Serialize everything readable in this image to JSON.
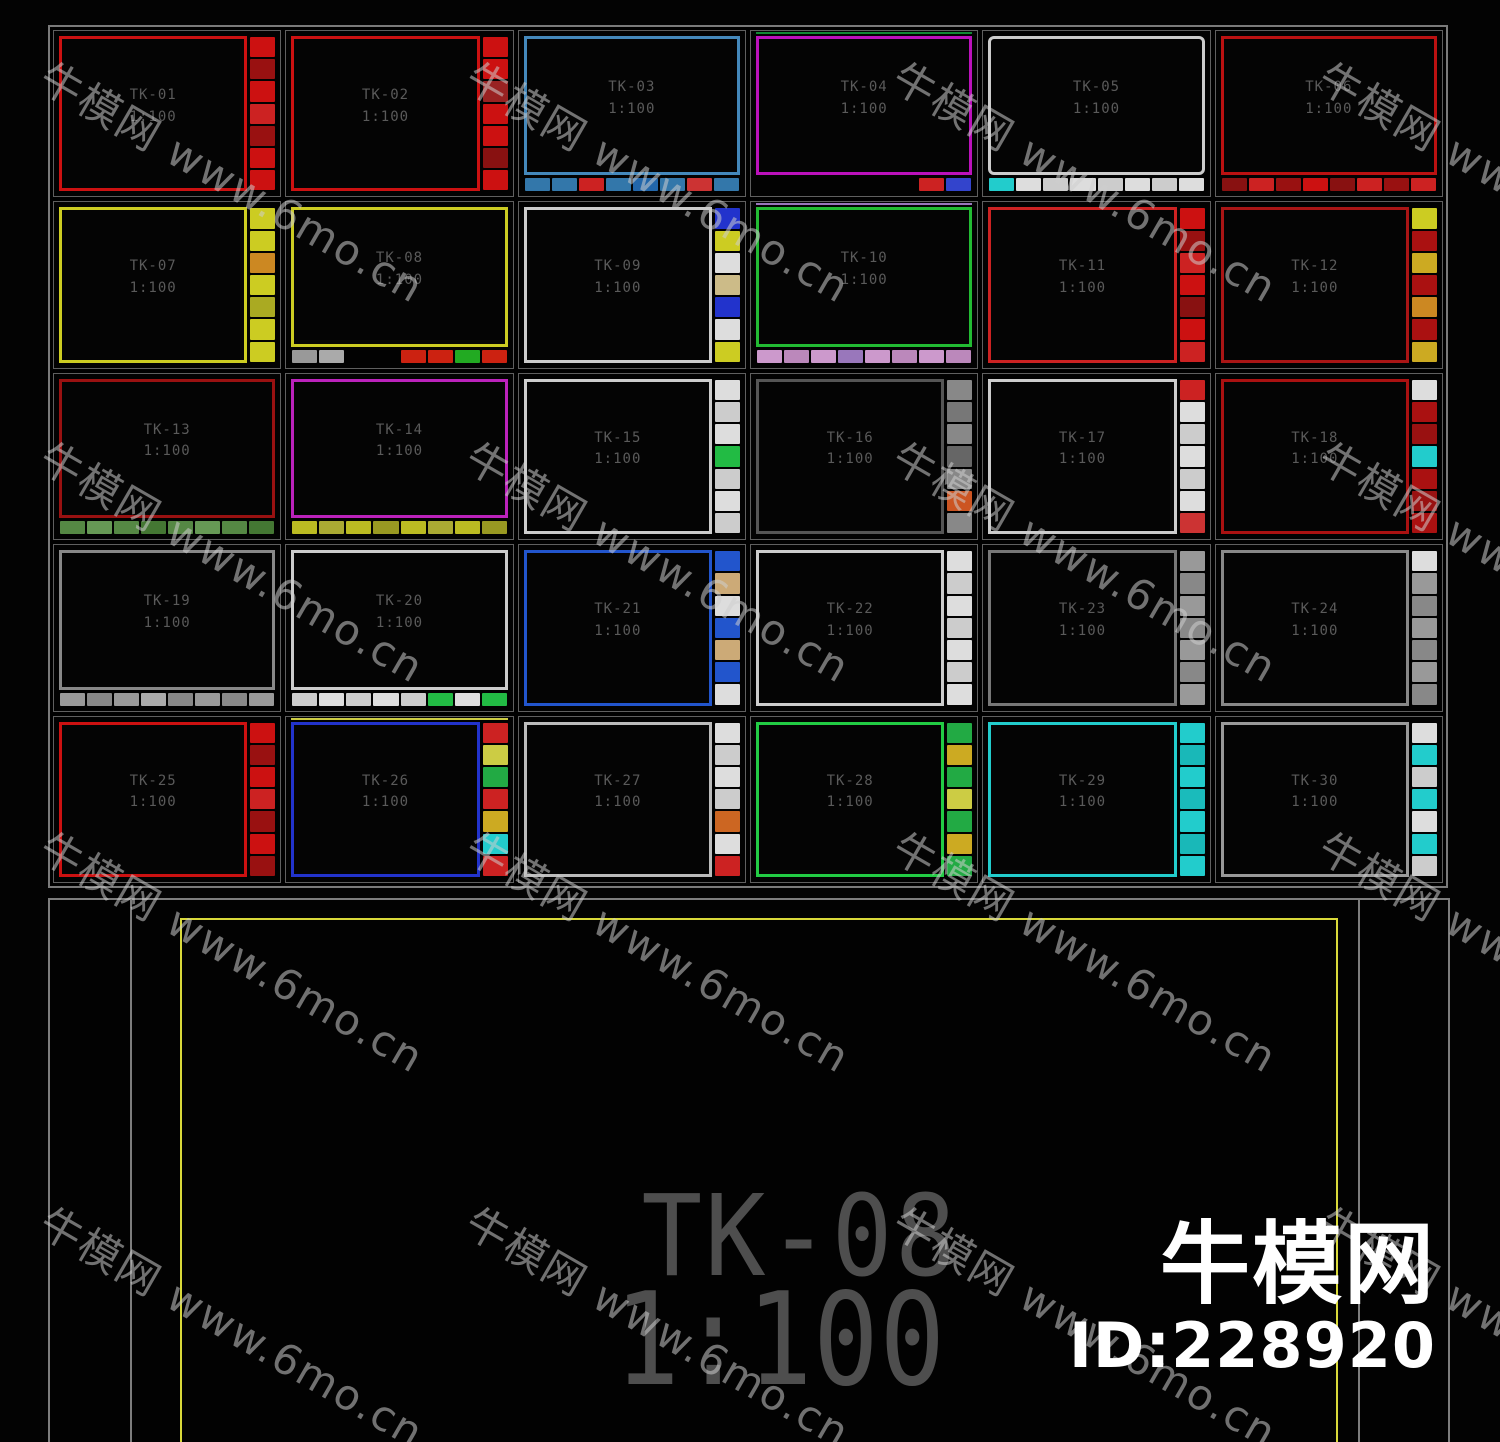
{
  "watermark": {
    "tile_text": "牛模网 www.6mo.cn",
    "logo_text": "牛模网",
    "logo_id": "ID:228920"
  },
  "bottom_sheet": {
    "title": "TK-08",
    "scale": "1:100",
    "frame_color": "#d9d93a"
  },
  "frames": [
    {
      "label": "TK-01",
      "scale": "1:100",
      "border": "#cc1111",
      "strip": "right",
      "blocks": [
        "#cc1111",
        "#991111",
        "#cc1111",
        "#cc2222",
        "#991111",
        "#cc1111",
        "#cc1111"
      ]
    },
    {
      "label": "TK-02",
      "scale": "1:100",
      "border": "#cc1111",
      "strip": "right",
      "blocks": [
        "#cc1111",
        "#cc1111",
        "#992222",
        "#cc1111",
        "#cc1111",
        "#881111",
        "#cc1111"
      ]
    },
    {
      "label": "TK-03",
      "scale": "1:100",
      "border": "#4488bb",
      "strip": "bottom",
      "blocks": [
        "#3377aa",
        "#3377aa",
        "#cc2222",
        "#3377aa",
        "#2266aa",
        "#3377aa",
        "#cc3333",
        "#3377aa"
      ]
    },
    {
      "label": "TK-04",
      "scale": "1:100",
      "border": "#bb11bb",
      "strip": "bottom",
      "accent": "#118833",
      "blocks": [
        "transparent",
        "transparent",
        "transparent",
        "transparent",
        "transparent",
        "transparent",
        "#cc2222",
        "#3344cc"
      ]
    },
    {
      "label": "TK-05",
      "scale": "1:100",
      "border": "#cccccc",
      "strip": "bottom",
      "radius": 6,
      "blocks": [
        "#22cccc",
        "#dddddd",
        "#cccccc",
        "#dddddd",
        "#cccccc",
        "#dddddd",
        "#cccccc",
        "#dddddd"
      ]
    },
    {
      "label": "TK-06",
      "scale": "1:100",
      "border": "#bb1111",
      "strip": "bottom",
      "blocks": [
        "#881111",
        "#cc2222",
        "#991111",
        "#cc1111",
        "#881111",
        "#cc2222",
        "#991111",
        "#cc2222"
      ]
    },
    {
      "label": "TK-07",
      "scale": "1:100",
      "border": "#cccc22",
      "strip": "right",
      "blocks": [
        "#cccc22",
        "#cccc22",
        "#cc8822",
        "#cccc22",
        "#aaaa22",
        "#cccc22",
        "#cccc22"
      ]
    },
    {
      "label": "TK-08",
      "scale": "1:100",
      "border": "#cccc22",
      "strip": "bottom",
      "blocks": [
        "#999999",
        "#aaaaaa",
        "transparent",
        "transparent",
        "#cc2211",
        "#cc2211",
        "#22aa22",
        "#cc2211"
      ]
    },
    {
      "label": "TK-09",
      "scale": "1:100",
      "border": "#cccccc",
      "strip": "right",
      "blocks": [
        "#2233cc",
        "#cccc22",
        "#dddddd",
        "#ccbb88",
        "#2233cc",
        "#dddddd",
        "#cccc22"
      ]
    },
    {
      "label": "TK-10",
      "scale": "1:100",
      "border": "#22bb33",
      "strip": "bottom",
      "accent": "#9977bb",
      "blocks": [
        "#cc99cc",
        "#bb88bb",
        "#cc99cc",
        "#9977bb",
        "#cc99cc",
        "#bb88bb",
        "#cc99cc",
        "#bb88bb"
      ]
    },
    {
      "label": "TK-11",
      "scale": "1:100",
      "border": "#cc2222",
      "strip": "right",
      "blocks": [
        "#cc1111",
        "#991111",
        "#cc2222",
        "#cc1111",
        "#881111",
        "#cc1111",
        "#cc2222"
      ]
    },
    {
      "label": "TK-12",
      "scale": "1:100",
      "border": "#aa1515",
      "strip": "right",
      "blocks": [
        "#cccc22",
        "#aa1111",
        "#ccaa22",
        "#aa1111",
        "#cc8822",
        "#aa1111",
        "#ccaa22"
      ]
    },
    {
      "label": "TK-13",
      "scale": "1:100",
      "border": "#991111",
      "strip": "bottom",
      "blocks": [
        "#558844",
        "#669955",
        "#558844",
        "#447733",
        "#558844",
        "#669955",
        "#558844",
        "#447733"
      ]
    },
    {
      "label": "TK-14",
      "scale": "1:100",
      "border": "#bb22bb",
      "strip": "bottom",
      "blocks": [
        "#bbbb22",
        "#aaaa33",
        "#bbbb22",
        "#999922",
        "#bbbb22",
        "#aaaa33",
        "#bbbb22",
        "#999922"
      ]
    },
    {
      "label": "TK-15",
      "scale": "1:100",
      "border": "#cccccc",
      "strip": "right",
      "blocks": [
        "#dddddd",
        "#cccccc",
        "#dddddd",
        "#22bb44",
        "#cccccc",
        "#dddddd",
        "#cccccc"
      ]
    },
    {
      "label": "TK-16",
      "scale": "1:100",
      "border": "#555555",
      "strip": "right",
      "blocks": [
        "#888888",
        "#777777",
        "#888888",
        "#666666",
        "#888888",
        "#cc5522",
        "#888888"
      ]
    },
    {
      "label": "TK-17",
      "scale": "1:100",
      "border": "#cccccc",
      "strip": "right",
      "blocks": [
        "#cc2222",
        "#dddddd",
        "#cccccc",
        "#dddddd",
        "#cccccc",
        "#dddddd",
        "#cc3333"
      ]
    },
    {
      "label": "TK-18",
      "scale": "1:100",
      "border": "#aa1111",
      "strip": "right",
      "blocks": [
        "#dddddd",
        "#aa1111",
        "#991111",
        "#22cccc",
        "#aa1111",
        "#991111",
        "#aa1111"
      ]
    },
    {
      "label": "TK-19",
      "scale": "1:100",
      "border": "#888888",
      "strip": "bottom",
      "blocks": [
        "#999999",
        "#888888",
        "#999999",
        "#aaaaaa",
        "#888888",
        "#999999",
        "#888888",
        "#999999"
      ]
    },
    {
      "label": "TK-20",
      "scale": "1:100",
      "border": "#cccccc",
      "strip": "bottom",
      "blocks": [
        "#cccccc",
        "#dddddd",
        "#cccccc",
        "#dddddd",
        "#cccccc",
        "#22bb44",
        "#dddddd",
        "#22bb44"
      ]
    },
    {
      "label": "TK-21",
      "scale": "1:100",
      "border": "#2255cc",
      "strip": "right",
      "blocks": [
        "#2255cc",
        "#ccaa77",
        "#dddddd",
        "#2255cc",
        "#ccaa77",
        "#2255cc",
        "#dddddd"
      ]
    },
    {
      "label": "TK-22",
      "scale": "1:100",
      "border": "#cccccc",
      "strip": "right",
      "blocks": [
        "#dddddd",
        "#cccccc",
        "#dddddd",
        "#cccccc",
        "#dddddd",
        "#cccccc",
        "#dddddd"
      ]
    },
    {
      "label": "TK-23",
      "scale": "1:100",
      "border": "#777777",
      "strip": "right",
      "blocks": [
        "#999999",
        "#888888",
        "#999999",
        "#888888",
        "#999999",
        "#888888",
        "#999999"
      ]
    },
    {
      "label": "TK-24",
      "scale": "1:100",
      "border": "#888888",
      "strip": "right",
      "blocks": [
        "#dddddd",
        "#999999",
        "#888888",
        "#999999",
        "#888888",
        "#999999",
        "#888888"
      ]
    },
    {
      "label": "TK-25",
      "scale": "1:100",
      "border": "#cc1111",
      "strip": "right",
      "blocks": [
        "#cc1111",
        "#991111",
        "#cc1111",
        "#cc2222",
        "#991111",
        "#cc1111",
        "#991111"
      ]
    },
    {
      "label": "TK-26",
      "scale": "1:100",
      "border": "#2233cc",
      "strip": "right",
      "accent": "#cccc44",
      "blocks": [
        "#cc2222",
        "#cccc44",
        "#22aa44",
        "#cc2222",
        "#ccaa22",
        "#22cccc",
        "#cc2222"
      ]
    },
    {
      "label": "TK-27",
      "scale": "1:100",
      "border": "#bbbbbb",
      "strip": "right",
      "blocks": [
        "#dddddd",
        "#cccccc",
        "#dddddd",
        "#cccccc",
        "#cc6622",
        "#dddddd",
        "#cc2222"
      ]
    },
    {
      "label": "TK-28",
      "scale": "1:100",
      "border": "#22cc44",
      "strip": "right",
      "blocks": [
        "#22aa44",
        "#ccaa22",
        "#22aa44",
        "#cccc44",
        "#22aa44",
        "#ccaa22",
        "#22aa44"
      ]
    },
    {
      "label": "TK-29",
      "scale": "1:100",
      "border": "#22cccc",
      "strip": "right",
      "blocks": [
        "#22cccc",
        "#19b8b8",
        "#22cccc",
        "#1abbbb",
        "#22cccc",
        "#19b8b8",
        "#22cccc"
      ]
    },
    {
      "label": "TK-30",
      "scale": "1:100",
      "border": "#999999",
      "strip": "right",
      "blocks": [
        "#dddddd",
        "#22cccc",
        "#cccccc",
        "#22cccc",
        "#dddddd",
        "#22cccc",
        "#cccccc"
      ]
    }
  ]
}
